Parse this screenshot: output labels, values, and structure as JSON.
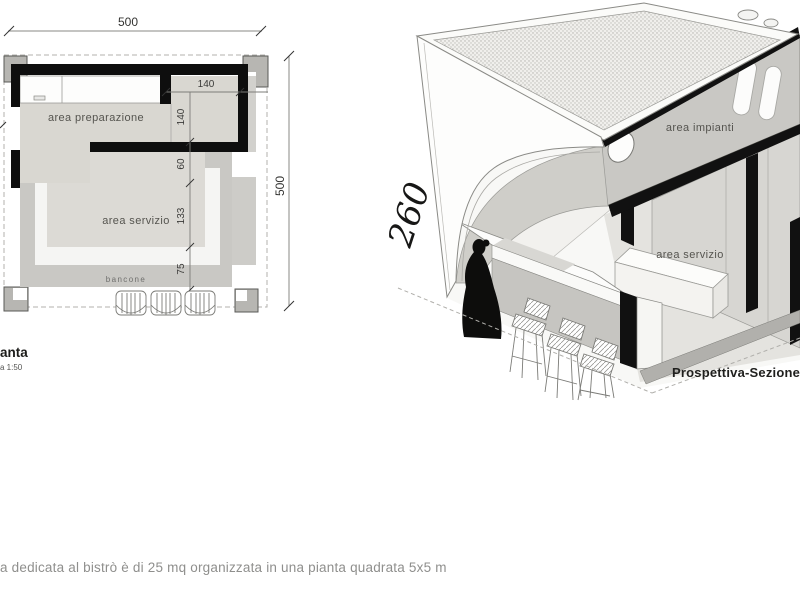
{
  "palette": {
    "ink": "#111111",
    "wall_black": "#0e0e0e",
    "plan_light_fill": "#d9d7d1",
    "plan_mid_fill": "#c9c8c4",
    "pillar_gray": "#b7b6b2",
    "caption_gray": "#8f8f8d"
  },
  "plan": {
    "title_fragment": "anta",
    "scale_fragment": "a 1:50",
    "area_preparation": "area preparazione",
    "area_service": "area servizio",
    "counter": "bancone",
    "dim_width_total": "500",
    "dim_height_total": "500",
    "dim_room_w": "140",
    "dim_room_h": "140",
    "dim_pass": "60",
    "dim_service": "133",
    "dim_counter": "75"
  },
  "perspective": {
    "title": "Prospettiva-Sezione",
    "height_dim": "260",
    "area_plant": "area impianti",
    "area_service": "area servizio"
  },
  "caption": "a dedicata al bistrò è di 25 mq organizzata in una pianta quadrata 5x5 m"
}
